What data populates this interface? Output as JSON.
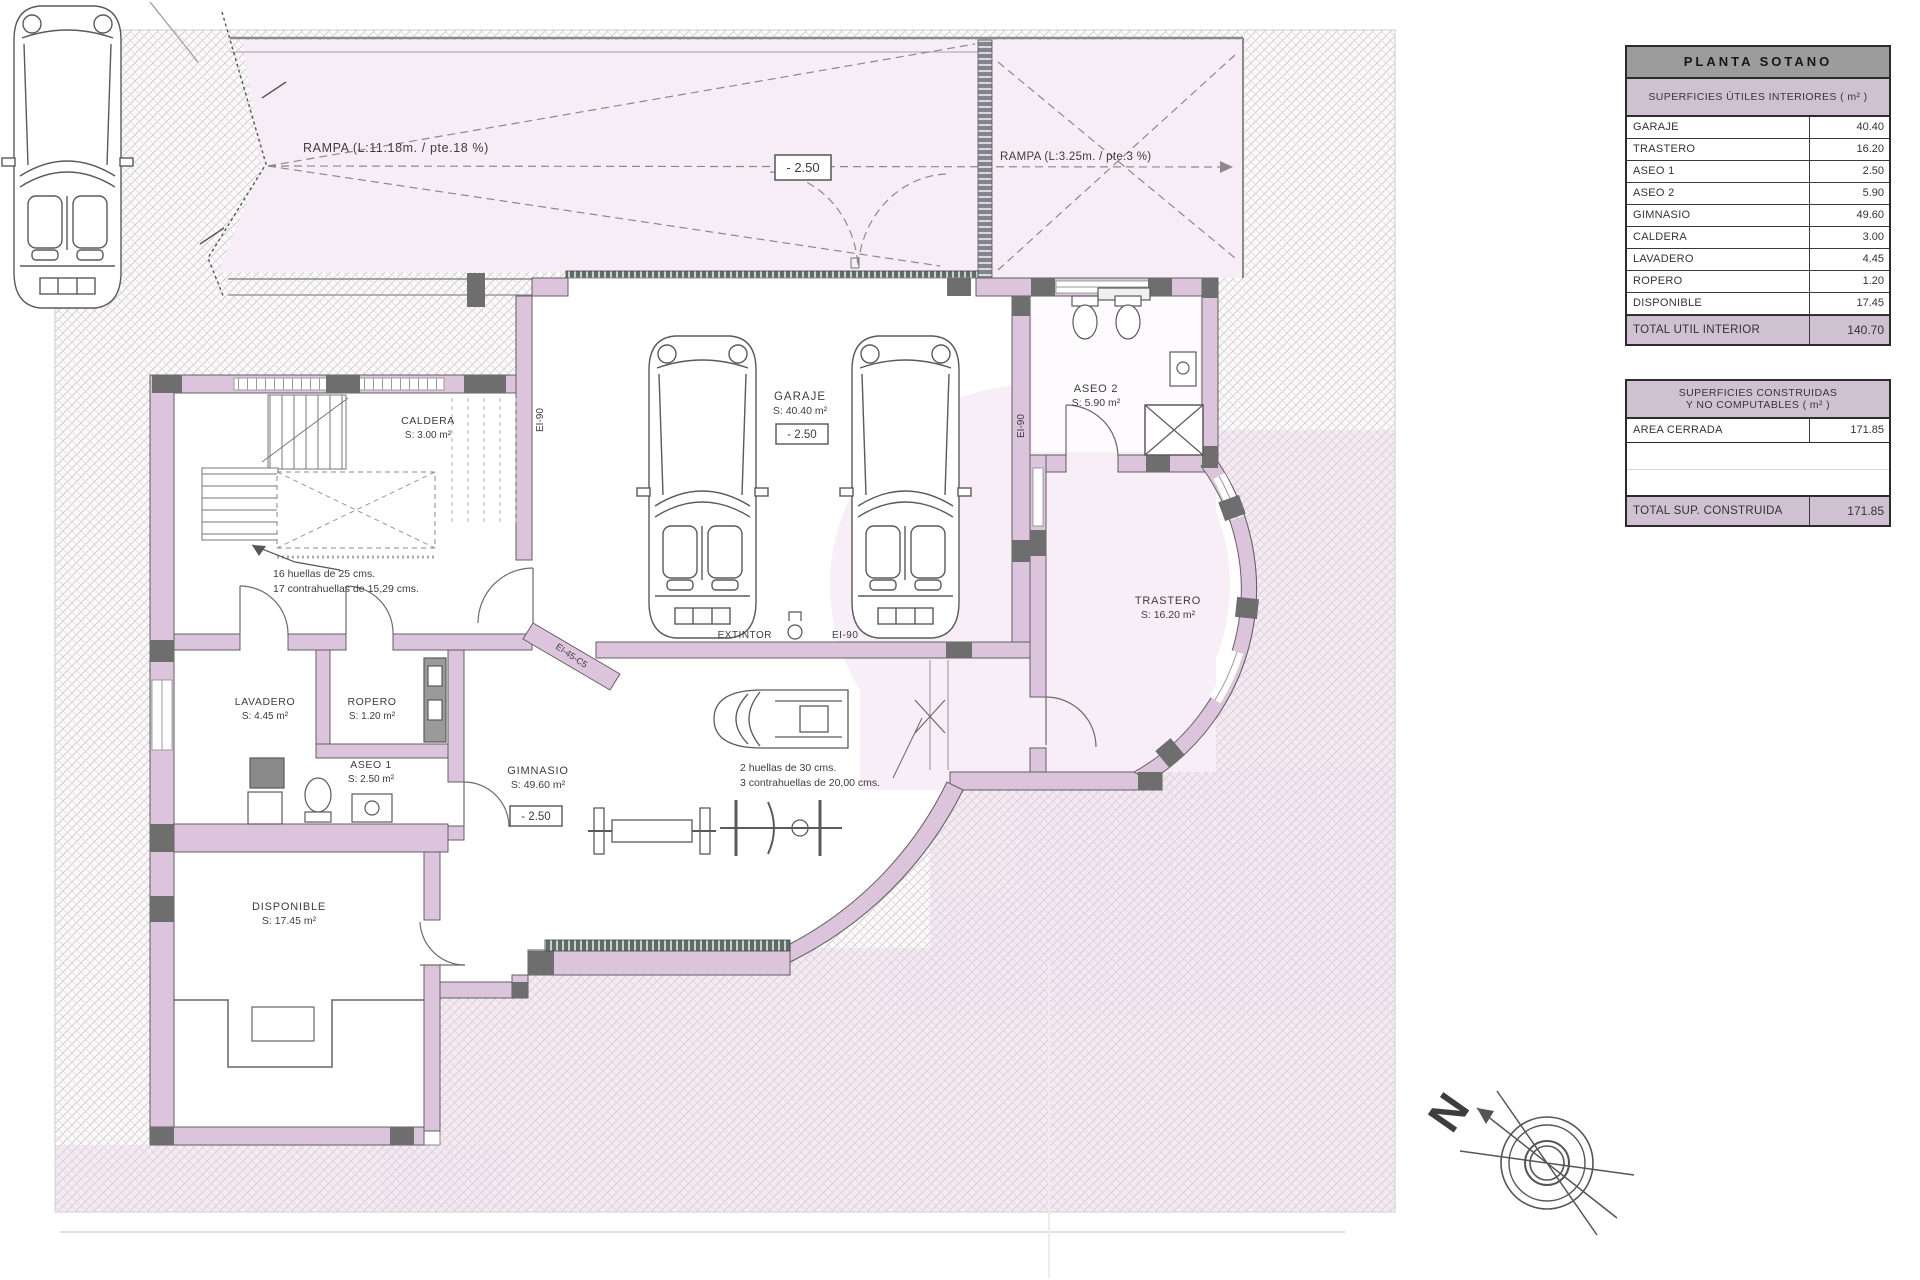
{
  "plan": {
    "ramps": {
      "main": "RAMPA (L:11.18m. / pte.18 %)",
      "secondary": "RAMPA (L:3.25m. / pte.3 %)"
    },
    "levels": {
      "ramp_box": "- 2.50",
      "garage_box": "- 2.50",
      "gym_box": "- 2.50"
    },
    "rooms": {
      "garaje": {
        "name": "GARAJE",
        "area": "S: 40.40 m²"
      },
      "aseo2": {
        "name": "ASEO 2",
        "area": "S: 5.90 m²"
      },
      "trastero": {
        "name": "TRASTERO",
        "area": "S: 16.20 m²"
      },
      "caldera": {
        "name": "CALDERA",
        "area": "S: 3.00 m²"
      },
      "lavadero": {
        "name": "LAVADERO",
        "area": "S: 4.45 m²"
      },
      "ropero": {
        "name": "ROPERO",
        "area": "S: 1.20 m²"
      },
      "aseo1": {
        "name": "ASEO 1",
        "area": "S: 2.50 m²"
      },
      "gimnasio": {
        "name": "GIMNASIO",
        "area": "S: 49.60 m²"
      },
      "disponible": {
        "name": "DISPONIBLE",
        "area": "S: 17.45 m²"
      }
    },
    "stairs": {
      "main_l1": "16 huellas de 25 cms.",
      "main_l2": "17 contrahuellas de 15,29 cms.",
      "hall_l1": "2 huellas de 30 cms.",
      "hall_l2": "3 contrahuellas de 20,00 cms."
    },
    "fire": {
      "extintor": "EXTINTOR",
      "ei90": "EI-90",
      "ei90_v_left": "EI-90",
      "ei90_v_right": "EI-90",
      "door_rating": "EI-45-C5"
    },
    "north": "N"
  },
  "tables": {
    "interior": {
      "title": "PLANTA SOTANO",
      "subtitle": "SUPERFICIES ÚTILES INTERIORES ( m² )",
      "rows": [
        {
          "label": "GARAJE",
          "value": "40.40"
        },
        {
          "label": "TRASTERO",
          "value": "16.20"
        },
        {
          "label": "ASEO 1",
          "value": "2.50"
        },
        {
          "label": "ASEO 2",
          "value": "5.90"
        },
        {
          "label": "GIMNASIO",
          "value": "49.60"
        },
        {
          "label": "CALDERA",
          "value": "3.00"
        },
        {
          "label": "LAVADERO",
          "value": "4.45"
        },
        {
          "label": "ROPERO",
          "value": "1.20"
        },
        {
          "label": "DISPONIBLE",
          "value": "17.45"
        }
      ],
      "total_label": "TOTAL UTIL INTERIOR",
      "total_value": "140.70"
    },
    "construida": {
      "title_l1": "SUPERFICIES CONSTRUIDAS",
      "title_l2": "Y NO COMPUTABLES ( m² )",
      "rows": [
        {
          "label": "AREA CERRADA",
          "value": "171.85"
        }
      ],
      "total_label": "TOTAL SUP. CONSTRUIDA",
      "total_value": "171.85"
    }
  },
  "colors": {
    "wall": "#dcc5dc",
    "pillar": "#6e6e6e",
    "ramp_bg": "#f7edf6",
    "hatch_line": "#c7c7c7",
    "table_header_bg": "#9c9c9c",
    "accent_bg": "#cfc0d2"
  }
}
